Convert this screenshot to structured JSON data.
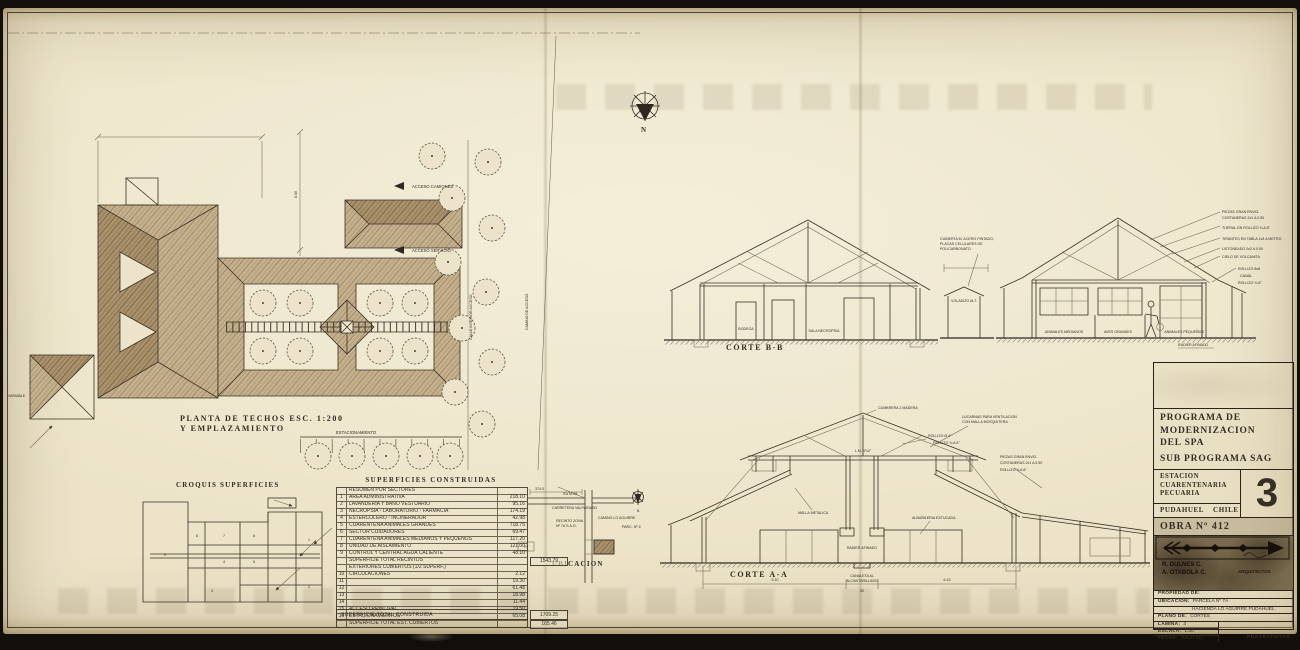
{
  "north": {
    "letter": "N"
  },
  "plan": {
    "title_1": "PLANTA DE TECHOS   ESC. 1:200",
    "title_2": "Y EMPLAZAMIENTO",
    "acceso_camiones": "ACCESO CAMIONES",
    "acceso_servicio": "ACCESO SERVICIO",
    "calle": "CALLE INTERIOR ACCESO",
    "camino": "CAMINO DE ACCESO",
    "variable": "VARIABLE",
    "estacionamiento": "ESTACIONAMIENTO",
    "dim_v": "8.60"
  },
  "croquis": {
    "title": "CROQUIS SUPERFICIES",
    "zones": [
      "1",
      "2",
      "3",
      "4",
      "5",
      "6",
      "7",
      "8",
      "9"
    ]
  },
  "table": {
    "title": "SUPERFICIES CONSTRUIDAS",
    "header": "RESUMEN POR SECTORES",
    "rows": [
      {
        "n": "1",
        "label": "AREA ADMINISTRATIVA",
        "val": "218.10"
      },
      {
        "n": "2",
        "label": "LAVANDERIA Y BAÑO VESTUARIO",
        "val": "95.16"
      },
      {
        "n": "3",
        "label": "NECROPSIA - LABORATORIO - FARMACIA",
        "val": "174.19"
      },
      {
        "n": "4",
        "label": "ESTERCOLERO - INCINERADOR",
        "val": "42.98"
      },
      {
        "n": "5",
        "label": "CUARENTENA ANIMALES GRANDES",
        "val": "718.75"
      },
      {
        "n": "6",
        "label": "SECTOR CUIDADORES",
        "val": "69.47"
      },
      {
        "n": "7",
        "label": "CUARENTENA ANIMALES MEDIANOS Y PEQUEÑOS",
        "val": "117.20"
      },
      {
        "n": "8",
        "label": "UNIDAD DE AISLAMIENTO",
        "val": "121.00"
      },
      {
        "n": "9",
        "label": "CONTROL Y CENTRAL AGUA CALIENTE",
        "val": "48.10"
      }
    ],
    "subtotal": {
      "label": "SUPERFICIE TOTAL RECINTOS",
      "val": "1543.79"
    },
    "ext_header": "EXTERIORES CUBIERTOS (1/2 SUPERF.)",
    "ext_rows": [
      {
        "n": "10",
        "label": "CIRCULACIONES",
        "val": "2.12"
      },
      {
        "n": "11",
        "label": "",
        "val": "19.30"
      },
      {
        "n": "12",
        "label": "",
        "val": "61.48"
      },
      {
        "n": "13",
        "label": "",
        "val": "18.98"
      },
      {
        "n": "14",
        "label": "",
        "val": "11.44"
      },
      {
        "n": "15",
        "label": "ACCESO PRINCIPAL",
        "val": "19.50"
      },
      {
        "n": "16",
        "label": "ESTACIONAMIENTOS",
        "val": "65.08"
      }
    ],
    "total_est": {
      "label": "SUPERFICIE TOTAL EST. CUBIERTOS",
      "val": "165.46"
    },
    "total": {
      "label": "SUPERFICIE TOTAL CONSTRUIDA",
      "val": "1709.25"
    }
  },
  "ubicacion": {
    "title": "UBICACION",
    "ruta_1": "RUTA 68",
    "ruta_2": "CARRETERA VALPARAISO",
    "zona_1": "RECINTO ZONA",
    "zona_2": "Nº 7A S.A.G.",
    "parc": "PARC. Nº 5",
    "note": "CAMINO LO AGUIRRE",
    "dim_top": "374.0",
    "dim_left": "79",
    "north": "N"
  },
  "corte_bb": {
    "title": "CORTE B-B",
    "room1": "BODEGA",
    "room2": "SALA NECROPSIA",
    "room3": "ANIMALES MEDIANOS",
    "room4": "AVES GRANDES",
    "room5": "ANIMALES PEQUEÑOS",
    "canopy_note": "VOLADIZO ALT.",
    "cubierta_1": "CUBIERTA M. ACERO PINTADO,",
    "cubierta_2": "PLACAS CELULARES DE",
    "cubierta_3": "POLICARBONATO",
    "note_1": "PIEZAS GRAN ENVIG.",
    "note_2": "COSTANERAS 2x1 A 0.50",
    "note_3": "TIJERAL EN ROLLIZO ¾ A 8\"",
    "note_4": "TIRANTES EN TABLA 1x4 A METRO",
    "note_5": "LISTONEADO 2x2 A 0.50",
    "note_6": "CIELO DE VOLCANITA",
    "eave_1": "ROLLIZO 8x8",
    "eave_2": "CANAL",
    "eave_3": "ROLLIZO ¾ 8\"",
    "floor_note": "RADIER AFINADO"
  },
  "corte_aa": {
    "title": "CORTE A-A",
    "cumbrera": "CUMBRERA 2 MADERA",
    "lucarnas_1": "LUCARNAS PARA VENTILACION",
    "lucarnas_2": "CON MALLA MOSQUITERA",
    "lm": "L.M. 4\"x2\"",
    "rollizo_1": "ROLLIZO Ø 4\"",
    "rollizo_2": "ROLLIZO ¾ A 8\"",
    "malla": "MALLA METALICA",
    "albanileria": "ALBAÑILERIA ESTUCADA",
    "radier": "RADIER AFINADO",
    "canaleta_1": "CANALETA AL",
    "canaleta_2": "ALCANTARILLADO",
    "right_1": "PIEZAS GRAN ENVIG.",
    "right_2": "COSTANERAS 2x1 A 0.50",
    "right_3": "ROLLIZO ¾ A 8\"",
    "dim_1": "5.10",
    "dim_2": "30",
    "dim_3": "6.15"
  },
  "titleblock": {
    "program_lines": [
      "PROGRAMA DE",
      "MODERNIZACION",
      "DEL SPA",
      "SUB PROGRAMA SAG"
    ],
    "estacion_lines": [
      "ESTACION",
      "CUARENTENARIA",
      "PECUARIA"
    ],
    "sheet_big": "3",
    "city": "PUDAHUEL CHILE",
    "obra": "OBRA Nº 412",
    "stamp": {
      "name1": "R. DULNES C.",
      "name2": "A. OTABOLA C.",
      "role": "ARQUITECTOS"
    },
    "propiedad_label": "PROPIEDAD DE:",
    "ubicacion_label": "UBICACION:",
    "ubicacion_value": "PARCELA Nº 7A",
    "ubicacion_value2": "HACIENDA LO AGUIRRE PUDAHUEL",
    "plano_label": "PLANO DE:",
    "plano_value": "CORTES",
    "lamina_label": "LAMINA:",
    "lamina_value": "3",
    "escala_label": "ESCALA:",
    "escala_value": "1:50",
    "fecha_label": "FECHA:",
    "fecha_value": "JULIO 91",
    "proyectistas": "PROYECTISTAS"
  }
}
